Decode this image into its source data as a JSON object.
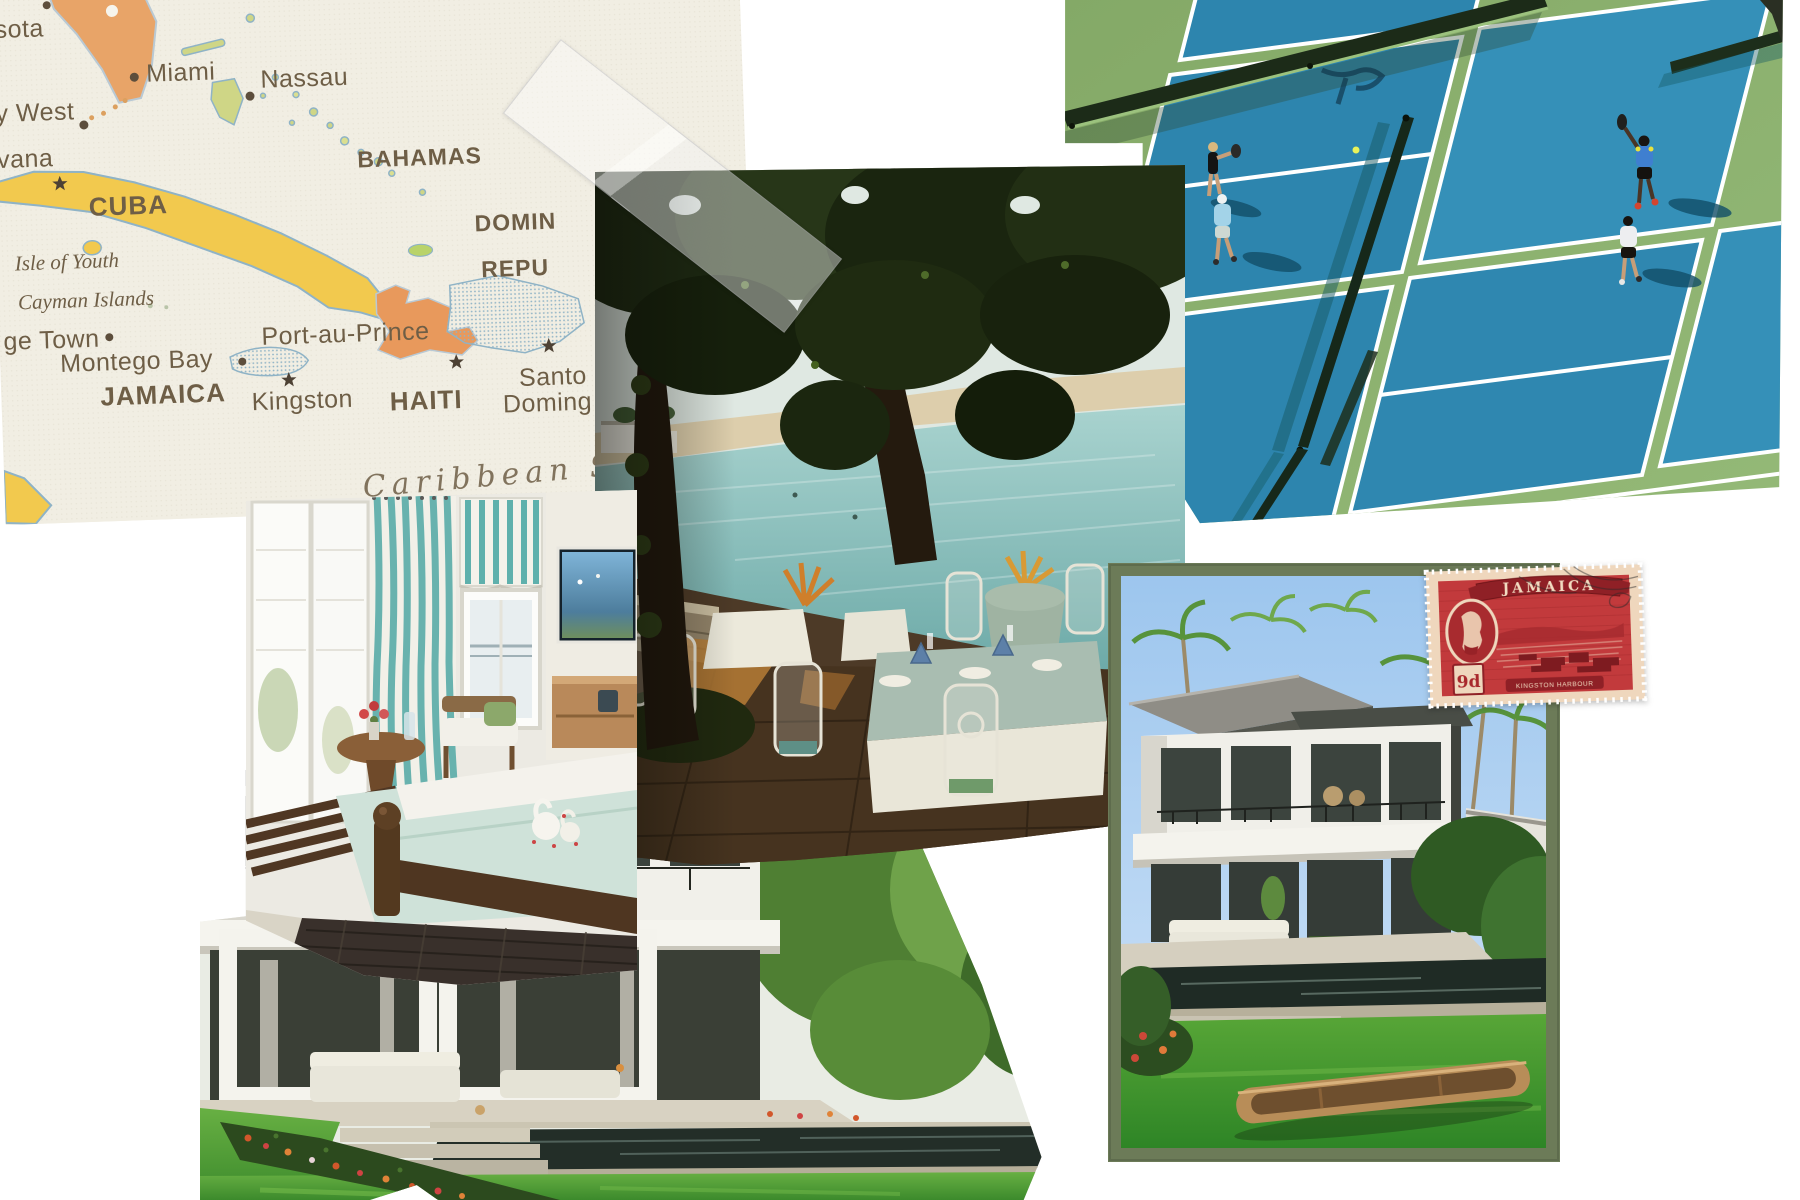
{
  "canvas": {
    "width": 1800,
    "height": 1200,
    "background": "#ffffff"
  },
  "map": {
    "paper_color": "#f1eee3",
    "sea_color": "#f3f2eb",
    "land_yellow": "#f2c94e",
    "land_orange": "#e8a468",
    "stipple_blue": "#9db8cc",
    "label_color": "#6e5e46",
    "sea_label_color": "#7e9ab4",
    "labels": {
      "sarasota": "sota",
      "miami": "Miami",
      "nassau": "Nassau",
      "key_west": "y West",
      "havana": "vana",
      "cuba": "CUBA",
      "bahamas": "BAHAMAS",
      "dominican_line1": "DOMIN",
      "dominican_line2": "REPU",
      "isle_of_youth": "Isle of Youth",
      "cayman_islands": "Cayman Islands",
      "george_town": "ge Town",
      "montego_bay": "Montego Bay",
      "jamaica": "JAMAICA",
      "kingston": "Kingston",
      "port_au_prince": "Port-au-Prince",
      "haiti": "HAITI",
      "santo_domingo_line1": "Santo",
      "santo_domingo_line2": "Doming",
      "caribbean_sea": "Caribbean S"
    }
  },
  "photos": {
    "tennis": {
      "court_blue": "#2d85ae",
      "court_green": "#8cb171",
      "net_dark": "#1c2b18"
    },
    "restaurant": {
      "water_teal": "#7fb7b3",
      "floor_brown": "#46331f",
      "canopy_green": "#1d2912"
    },
    "bedroom": {
      "accent_teal": "#68b2ae",
      "bedspread_seafoam": "#cfe2d9",
      "wood_brown": "#53391f"
    },
    "villa_lawn": {
      "lawn_green": "#54a238",
      "pool_dark": "#232e28",
      "wall_white": "#f1f0ea"
    },
    "villa_framed": {
      "frame_color": "#6c7b58",
      "sky_blue": "#9dc6ee"
    }
  },
  "stamp": {
    "country": "JAMAICA",
    "denomination": "9d",
    "caption": "KINGSTON HARBOUR",
    "red": "#c23a3c",
    "paper": "#efd7bd",
    "dark_red": "#8f2026"
  }
}
